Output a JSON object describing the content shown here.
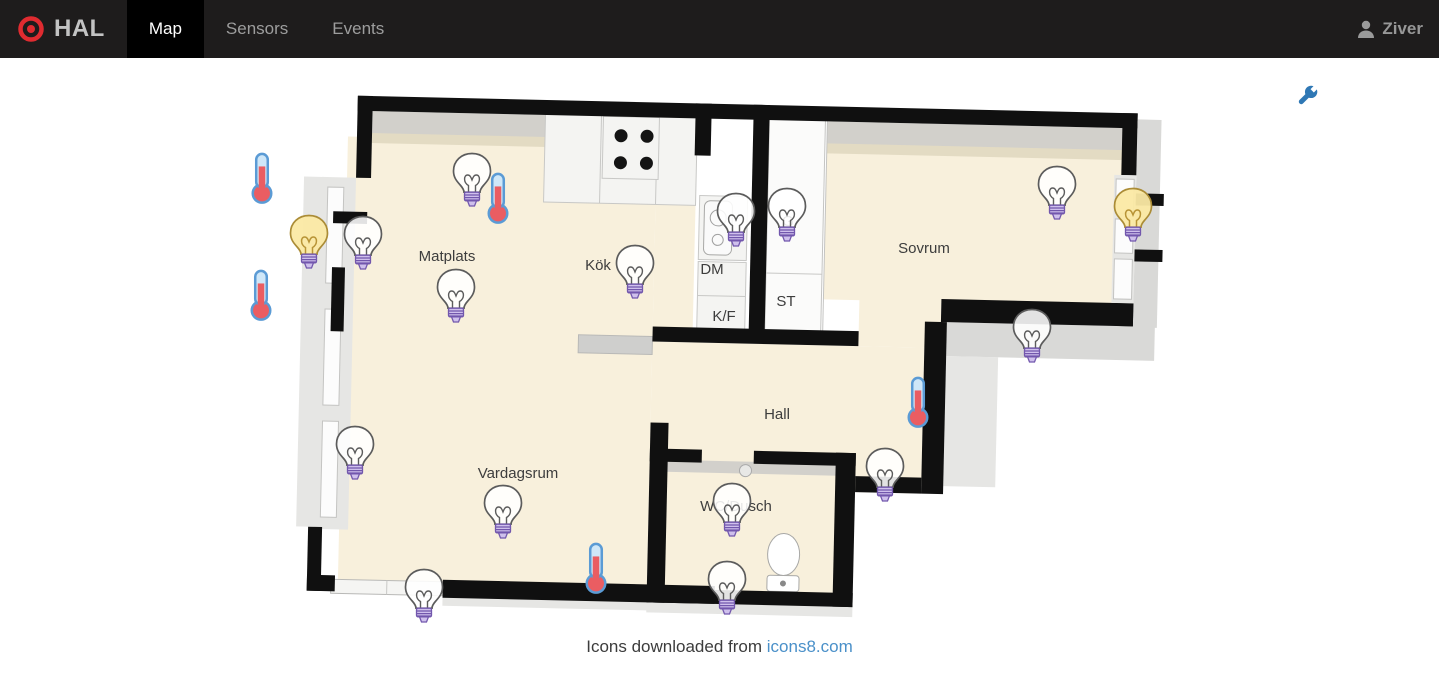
{
  "navbar": {
    "brand": "HAL",
    "tabs": [
      {
        "label": "Map",
        "active": true
      },
      {
        "label": "Sensors",
        "active": false
      },
      {
        "label": "Events",
        "active": false
      }
    ],
    "user": "Ziver"
  },
  "map": {
    "rooms": [
      {
        "label": "Matplats"
      },
      {
        "label": "Kök"
      },
      {
        "label": "DM"
      },
      {
        "label": "K/F"
      },
      {
        "label": "ST"
      },
      {
        "label": "G"
      },
      {
        "label": "Sovrum"
      },
      {
        "label": "Hall"
      },
      {
        "label": "Vardagsrum"
      },
      {
        "label": "WC/Dusch"
      }
    ],
    "sensors": [
      {
        "type": "thermometer",
        "x": 262,
        "y": 178
      },
      {
        "type": "thermometer",
        "x": 261,
        "y": 295
      },
      {
        "type": "thermometer",
        "x": 498,
        "y": 198
      },
      {
        "type": "thermometer",
        "x": 918,
        "y": 402
      },
      {
        "type": "thermometer",
        "x": 596,
        "y": 568
      },
      {
        "type": "bulb-on",
        "x": 309,
        "y": 242
      },
      {
        "type": "bulb-on",
        "x": 1133,
        "y": 215
      },
      {
        "type": "bulb-off",
        "x": 472,
        "y": 180
      },
      {
        "type": "bulb-off",
        "x": 363,
        "y": 243
      },
      {
        "type": "bulb-off",
        "x": 456,
        "y": 296
      },
      {
        "type": "bulb-off",
        "x": 635,
        "y": 272
      },
      {
        "type": "bulb-off",
        "x": 736,
        "y": 220
      },
      {
        "type": "bulb-off",
        "x": 787,
        "y": 215
      },
      {
        "type": "bulb-off",
        "x": 1057,
        "y": 193
      },
      {
        "type": "bulb-off",
        "x": 1032,
        "y": 336
      },
      {
        "type": "bulb-off",
        "x": 355,
        "y": 453
      },
      {
        "type": "bulb-off",
        "x": 503,
        "y": 512
      },
      {
        "type": "bulb-off",
        "x": 424,
        "y": 596
      },
      {
        "type": "bulb-off",
        "x": 885,
        "y": 475
      },
      {
        "type": "bulb-off",
        "x": 732,
        "y": 510
      },
      {
        "type": "bulb-off",
        "x": 727,
        "y": 588
      }
    ]
  },
  "footer": {
    "text": "Icons downloaded from",
    "link_label": "icons8.com"
  },
  "colors": {
    "accent_blue": "#2f78b5",
    "link_blue": "#4a90c9",
    "bulb_on_fill": "#fbe9a4",
    "thermo_red": "#ea5d62",
    "navbar_bg": "#1e1c1c",
    "tab_active_bg": "#000000"
  }
}
